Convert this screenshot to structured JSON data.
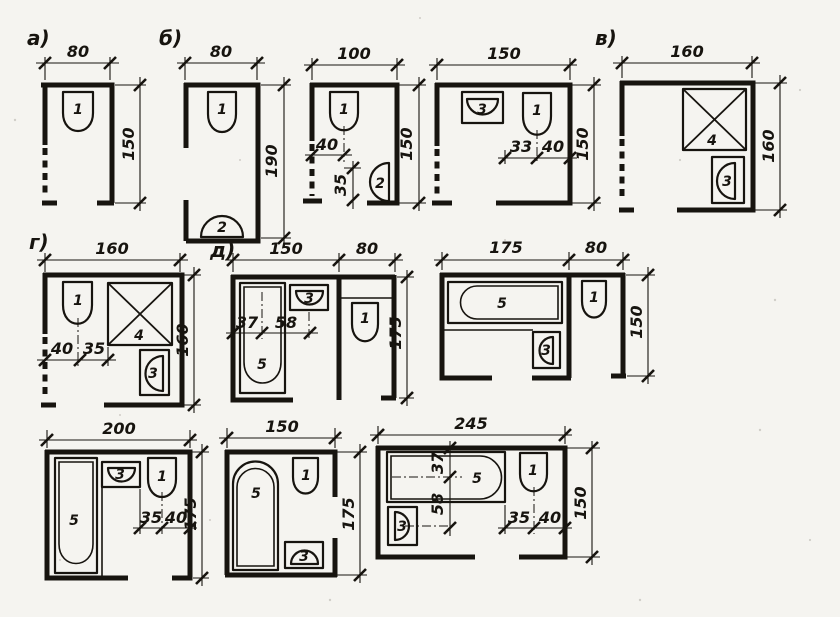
{
  "sheet": {
    "ink_color": "#17140f",
    "paper_color": "#f5f4f0"
  },
  "plans": {
    "a": {
      "label": "а)",
      "width": "80",
      "height": "150",
      "fixtures": {
        "toilet": "1"
      }
    },
    "b": {
      "label": "б)",
      "width": "80",
      "height": "190",
      "fixtures": {
        "toilet": "1",
        "washbasin": "2"
      }
    },
    "c": {
      "width": "100",
      "height": "150",
      "fixtures": {
        "toilet": "1",
        "washbasin": "2"
      },
      "inner_dims": {
        "toilet_offset": "40",
        "basin_offset": "35"
      }
    },
    "d": {
      "width": "150",
      "height": "150",
      "fixtures": {
        "washbasin": "3",
        "toilet": "1"
      },
      "inner_dims": {
        "gap": "33",
        "toilet_offset": "40"
      }
    },
    "v": {
      "label": "в)",
      "width": "160",
      "height": "160",
      "fixtures": {
        "shower": "4",
        "washbasin": "3"
      }
    },
    "g": {
      "label": "г)",
      "width": "160",
      "height": "160",
      "fixtures": {
        "toilet": "1",
        "shower": "4",
        "washbasin": "3"
      },
      "inner_dims": {
        "toilet_offset": "40",
        "gap": "35"
      }
    },
    "dd": {
      "label": "д)",
      "width_left": "150",
      "width_right": "80",
      "height": "175",
      "fixtures": {
        "bathtub": "5",
        "washbasin": "3",
        "toilet": "1"
      },
      "inner_dims": {
        "tub_offset": "37",
        "basin_offset": "58"
      }
    },
    "h": {
      "width_left": "175",
      "width_right": "80",
      "height": "150",
      "fixtures": {
        "bathtub": "5",
        "washbasin": "3",
        "toilet": "1"
      }
    },
    "i": {
      "width": "200",
      "height": "175",
      "fixtures": {
        "bathtub": "5",
        "washbasin": "3",
        "toilet": "1"
      },
      "inner_dims": {
        "gap": "35",
        "toilet_offset": "40"
      }
    },
    "j": {
      "width": "150",
      "height": "175",
      "fixtures": {
        "bathtub": "5",
        "toilet": "1",
        "washbasin": "3"
      }
    },
    "k": {
      "width": "245",
      "height": "150",
      "fixtures": {
        "bathtub": "5",
        "washbasin": "3",
        "toilet": "1"
      },
      "inner_dims": {
        "tub_offset": "37",
        "basin_offset": "58",
        "gap": "35",
        "toilet_offset": "40"
      }
    }
  }
}
